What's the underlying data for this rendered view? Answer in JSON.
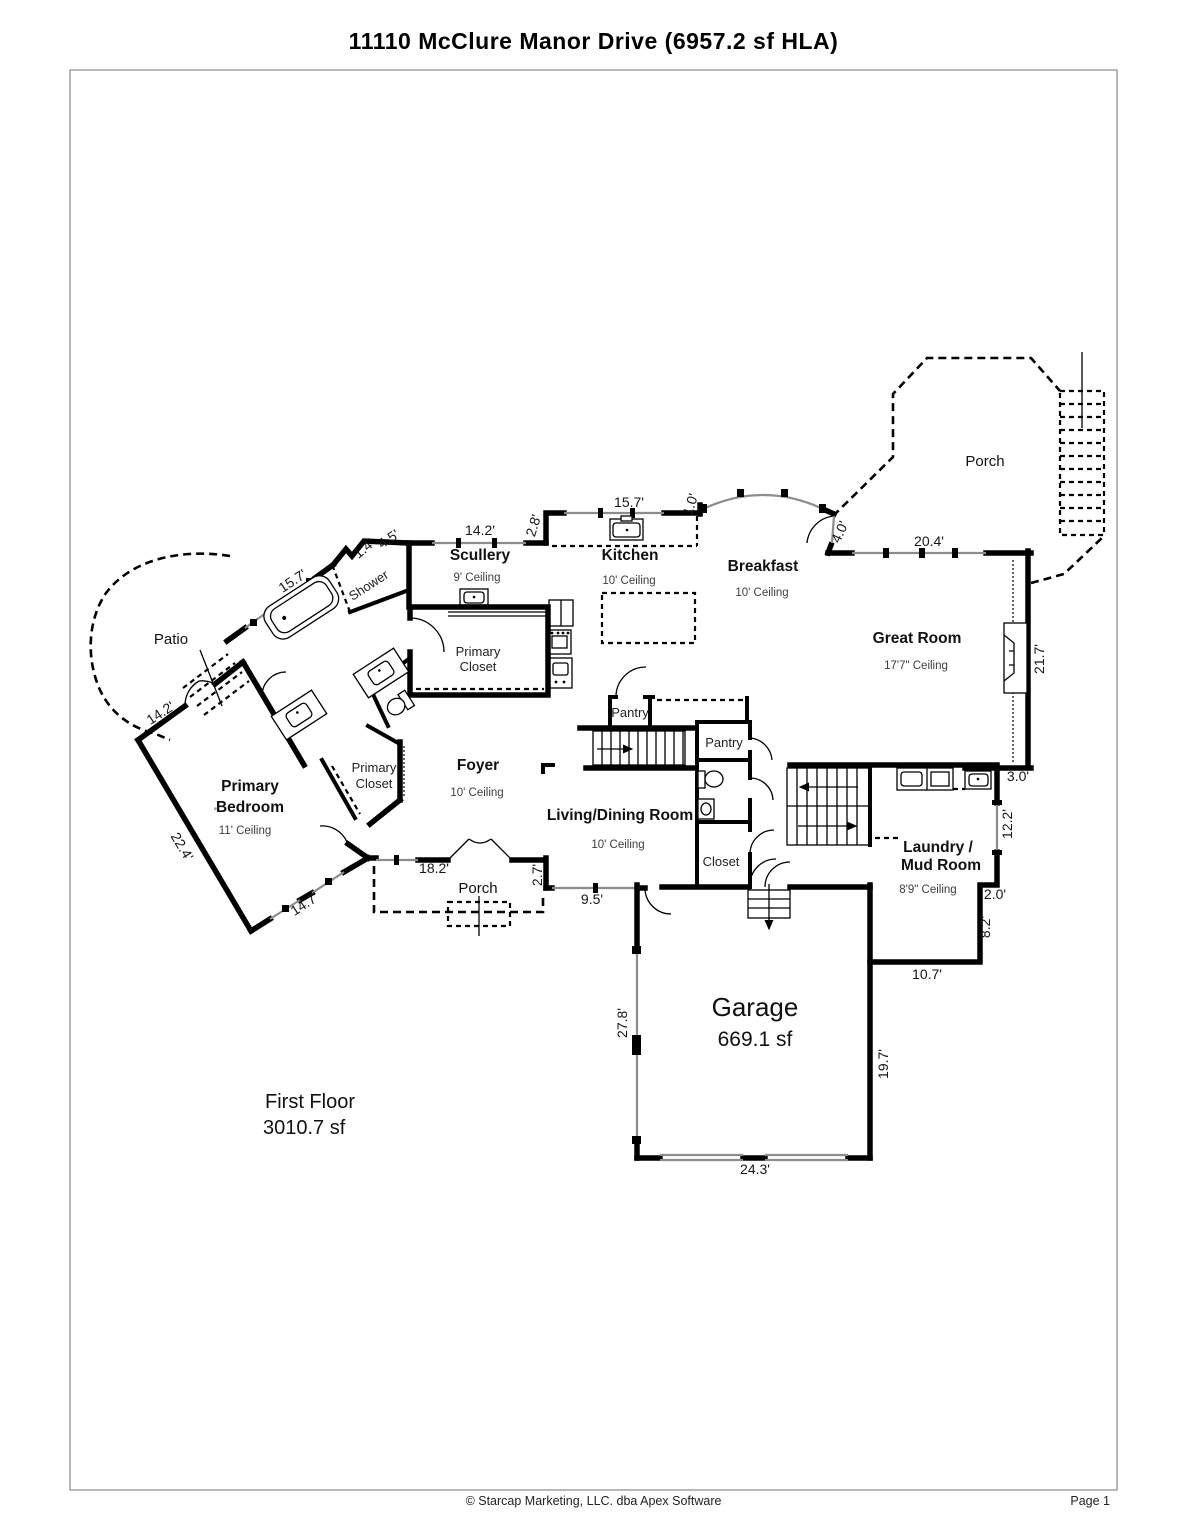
{
  "page": {
    "title": "11110 McClure Manor Drive (6957.2 sf HLA)",
    "footer_copyright": "© Starcap Marketing, LLC. dba Apex Software",
    "footer_page": "Page 1"
  },
  "summary": {
    "floor_name": "First Floor",
    "floor_area": "3010.7 sf"
  },
  "rooms": {
    "upper_porch": {
      "label": "Porch"
    },
    "great_room": {
      "label": "Great Room",
      "ceiling": "17'7\" Ceiling"
    },
    "breakfast": {
      "label": "Breakfast",
      "ceiling": "10' Ceiling"
    },
    "kitchen": {
      "label": "Kitchen",
      "ceiling": "10' Ceiling"
    },
    "scullery": {
      "label": "Scullery",
      "ceiling": "9' Ceiling"
    },
    "shower": {
      "label": "Shower"
    },
    "primary_closet_upper": {
      "line1": "Primary",
      "line2": "Closet"
    },
    "patio": {
      "label": "Patio"
    },
    "primary_bedroom": {
      "line1": "Primary",
      "line2": "Bedroom",
      "ceiling": "11' Ceiling",
      "mark": "\""
    },
    "primary_closet_lower": {
      "line1": "Primary",
      "line2": "Closet"
    },
    "foyer": {
      "label": "Foyer",
      "ceiling": "10' Ceiling"
    },
    "pantry_upper": {
      "label": "Pantry"
    },
    "pantry_lower": {
      "label": "Pantry"
    },
    "living_dining": {
      "label": "Living/Dining Room",
      "ceiling": "10' Ceiling"
    },
    "hall_closet": {
      "label": "Closet"
    },
    "lower_porch": {
      "label": "Porch"
    },
    "laundry": {
      "line1": "Laundry /",
      "line2": "Mud Room",
      "ceiling": "8'9\" Ceiling"
    },
    "garage": {
      "label": "Garage",
      "area": "669.1 sf"
    }
  },
  "dims": {
    "scullery_top": "14.2'",
    "kitchen_top": "15.7'",
    "kitchen_jog": "2.8'",
    "bay_stub": "1.0'",
    "breakfast_door": "4.0'",
    "great_top": "20.4'",
    "great_right": "21.7'",
    "laundry_offset": "3.0'",
    "laundry_right": "12.2'",
    "laundry_jog": "2.0'",
    "laundry_lower_right": "8.2'",
    "laundry_bottom": "10.7'",
    "garage_right": "19.7'",
    "garage_bottom": "24.3'",
    "garage_left": "27.8'",
    "living_bottom": "9.5'",
    "porch_jog": "2.7'",
    "porch_width": "18.2'",
    "bedroom_south": "14.7'",
    "bedroom_west": "22.4'",
    "patio_wall": "14.2'",
    "bath_wall": "15.7'",
    "shower_wall": "4.5'",
    "shower_jog": "1.4'"
  },
  "colors": {
    "wall": "#000000",
    "window": "#8c8c8c",
    "page_border": "#9a9a9a"
  }
}
